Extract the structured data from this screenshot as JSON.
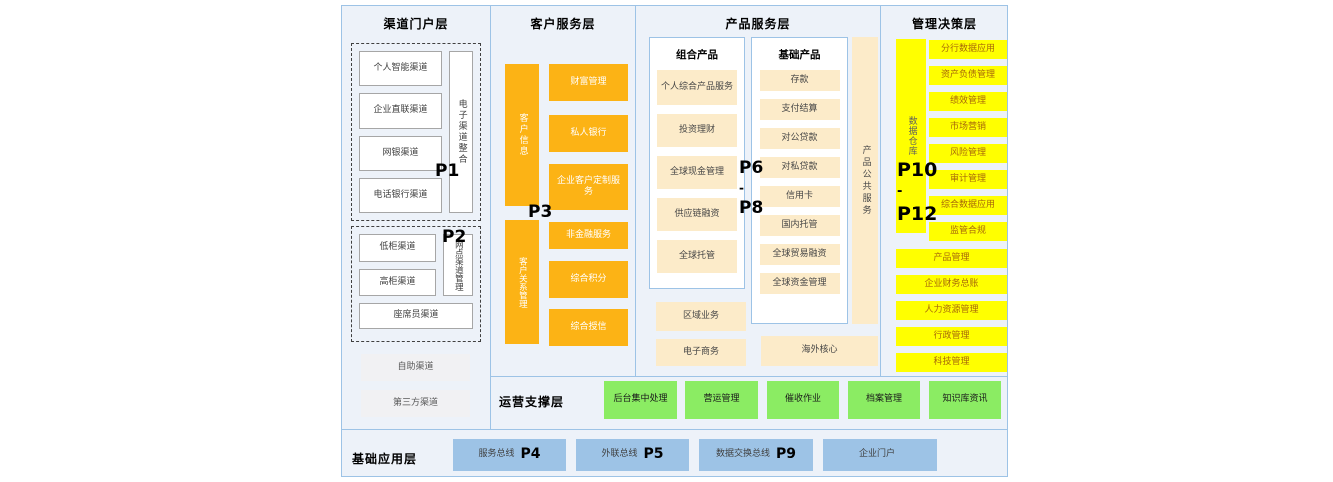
{
  "colors": {
    "background": "#edf2f9",
    "border_blue": "#9dc3e6",
    "orange": "#fcb315",
    "cream": "#fcebc9",
    "yellow": "#ffff00",
    "green": "#8bec63",
    "blue": "#9dc3e6"
  },
  "layers": {
    "channel": {
      "title": "渠道门户层",
      "p1_label": "P1",
      "p1_items": [
        "个人智能渠道",
        "企业直联渠道",
        "网银渠道",
        "电话银行渠道"
      ],
      "p1_side": "电子渠道整合",
      "p2_label": "P2",
      "p2_items": [
        "低柜渠道",
        "高柜渠道"
      ],
      "p2_side": "网点渠道管理",
      "p2_bottom": "座席员渠道",
      "extra_items": [
        "自助渠道",
        "第三方渠道"
      ]
    },
    "customer": {
      "title": "客户服务层",
      "p3_label": "P3",
      "bar_top": "客户信息",
      "bar_bottom": "客户关系管理",
      "items": [
        "财富管理",
        "私人银行",
        "企业客户定制服务",
        "非金融服务",
        "综合积分",
        "综合授信"
      ]
    },
    "product": {
      "title": "产品服务层",
      "p_range": {
        "top": "P6",
        "sep": "-",
        "bottom": "P8"
      },
      "combo": {
        "header": "组合产品",
        "items": [
          "个人综合产品服务",
          "投资理财",
          "全球现金管理",
          "供应链融资",
          "全球托管"
        ]
      },
      "basic": {
        "header": "基础产品",
        "items": [
          "存款",
          "支付结算",
          "对公贷款",
          "对私贷款",
          "信用卡",
          "国内托管",
          "全球贸易融资",
          "全球资金管理"
        ]
      },
      "side_bar": "产品公共服务",
      "extra_left": [
        "区域业务",
        "电子商务"
      ],
      "extra_right": "海外核心"
    },
    "management": {
      "title": "管理决策层",
      "p_range": {
        "top": "P10",
        "sep": "-",
        "bottom": "P12"
      },
      "bar": "数据仓库",
      "dw_items": [
        "分行数据应用",
        "资产负债管理",
        "绩效管理",
        "市场营销",
        "风险管理",
        "审计管理",
        "综合数据应用",
        "监管合规"
      ],
      "full_items": [
        "产品管理",
        "企业财务总账",
        "人力资源管理",
        "行政管理",
        "科技管理"
      ]
    },
    "operations": {
      "title": "运营支撑层",
      "items": [
        "后台集中处理",
        "营运管理",
        "催收作业",
        "档案管理",
        "知识库资讯"
      ]
    },
    "foundation": {
      "title": "基础应用层",
      "items": [
        {
          "label": "服务总线",
          "p": "P4"
        },
        {
          "label": "外联总线",
          "p": "P5"
        },
        {
          "label": "数据交换总线",
          "p": "P9"
        },
        {
          "label": "企业门户",
          "p": ""
        }
      ]
    }
  }
}
